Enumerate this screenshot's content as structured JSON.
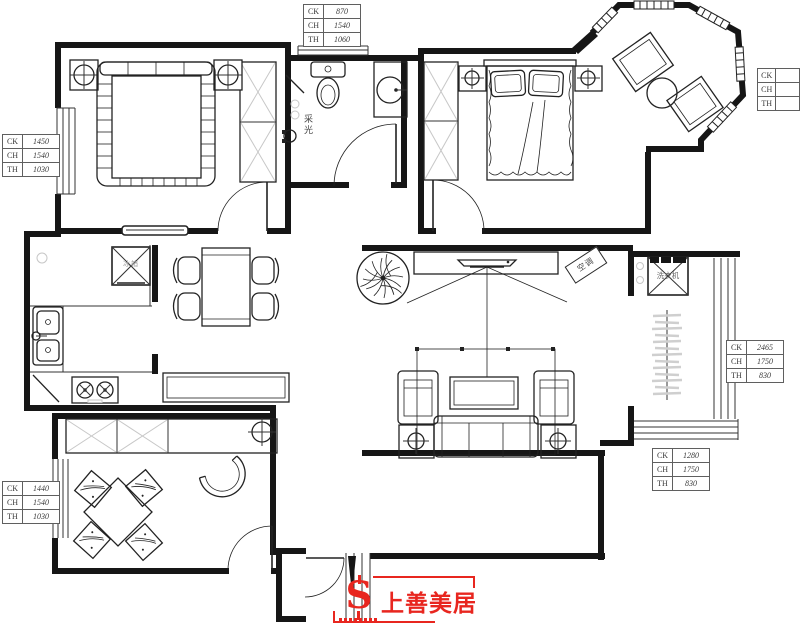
{
  "annotations": {
    "bathroom_light": "采光",
    "washing_machine": "洗衣机",
    "fridge": "冰箱",
    "ac_unit": "空调"
  },
  "logo": {
    "brand": "上善美居",
    "accent_color": "#e8261f"
  },
  "dimension_tables": [
    {
      "id": "top-center",
      "rows": [
        {
          "label": "CK",
          "value": "870"
        },
        {
          "label": "CH",
          "value": "1540"
        },
        {
          "label": "TH",
          "value": "1060"
        }
      ]
    },
    {
      "id": "left-upper",
      "rows": [
        {
          "label": "CK",
          "value": "1450"
        },
        {
          "label": "CH",
          "value": "1540"
        },
        {
          "label": "TH",
          "value": "1030"
        }
      ]
    },
    {
      "id": "right-top",
      "rows": [
        {
          "label": "CK",
          "value": ""
        },
        {
          "label": "CH",
          "value": ""
        },
        {
          "label": "TH",
          "value": ""
        }
      ]
    },
    {
      "id": "right-middle",
      "rows": [
        {
          "label": "CK",
          "value": "2465"
        },
        {
          "label": "CH",
          "value": "1750"
        },
        {
          "label": "TH",
          "value": "830"
        }
      ]
    },
    {
      "id": "right-lower",
      "rows": [
        {
          "label": "CK",
          "value": "1280"
        },
        {
          "label": "CH",
          "value": "1750"
        },
        {
          "label": "TH",
          "value": "830"
        }
      ]
    },
    {
      "id": "left-lower",
      "rows": [
        {
          "label": "CK",
          "value": "1440"
        },
        {
          "label": "CH",
          "value": "1540"
        },
        {
          "label": "TH",
          "value": "1030"
        }
      ]
    }
  ]
}
